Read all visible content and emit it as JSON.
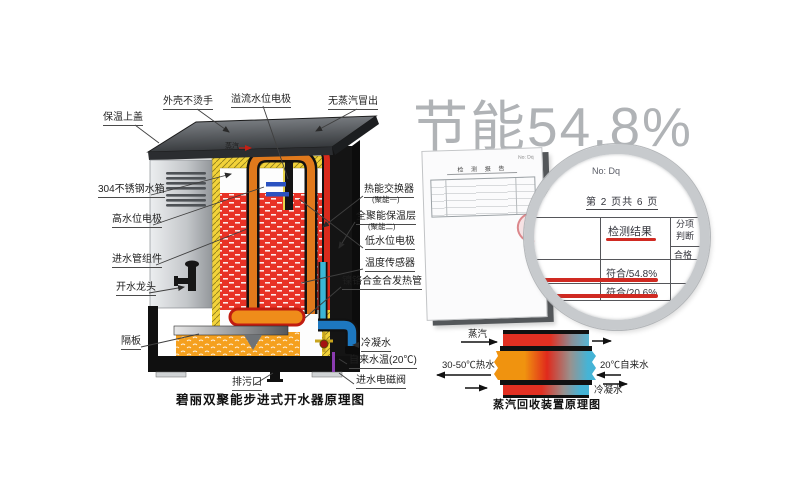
{
  "title": {
    "text": "节能54.8%",
    "color": "#b0b3b6"
  },
  "heater": {
    "caption": "碧丽双聚能步进式开水器原理图",
    "labels": {
      "shell": "外壳不烫手",
      "overflow_electrode": "溢流水位电极",
      "no_steam": "无蒸汽冒出",
      "top_cover": "保温上盖",
      "tank": "304不锈钢水箱",
      "high_electrode": "高水位电极",
      "inlet_assembly": "进水管组件",
      "tap": "开水龙头",
      "partition": "隔板",
      "heat_exchanger": "热能交换器",
      "heat_exchanger_sub": "(聚能一)",
      "insulation": "全聚能保温层",
      "insulation_sub": "(聚能二)",
      "low_electrode": "低水位电极",
      "temp_sensor": "温度传感器",
      "heating_tube": "镍铬合金合发热管",
      "condensate": "冷凝水",
      "tap_water_temp": "自来水温(20℃)",
      "inlet_valve": "进水电磁阀",
      "drain": "排污口",
      "steam_inline": "蒸汽"
    }
  },
  "report": {
    "doc_title": "检 测 报 告",
    "no_line": "No: Dq",
    "page_line": "第 2 页共 6 页",
    "result_header": "检测结果",
    "col_line1": "分项",
    "col_line2": "判断",
    "col_pass": "合格",
    "row1": "符合/54.8%",
    "row2": "符合/20.6%",
    "underline_color": "#d02a22"
  },
  "recovery": {
    "caption": "蒸汽回收装置原理图",
    "steam_in": "蒸汽",
    "hot_out": "30-50℃热水",
    "tap_in": "20℃自来水",
    "condensate_out": "冷凝水"
  },
  "colors": {
    "water_red": "#e83226",
    "insulation_yellow": "#f2d23a",
    "bottom_orange": "#f5a01e",
    "pipe_orange": "#e0791c",
    "pipe_red": "#d92a1c",
    "pipe_blue": "#1d78c0",
    "cyan": "#45b4d6"
  }
}
